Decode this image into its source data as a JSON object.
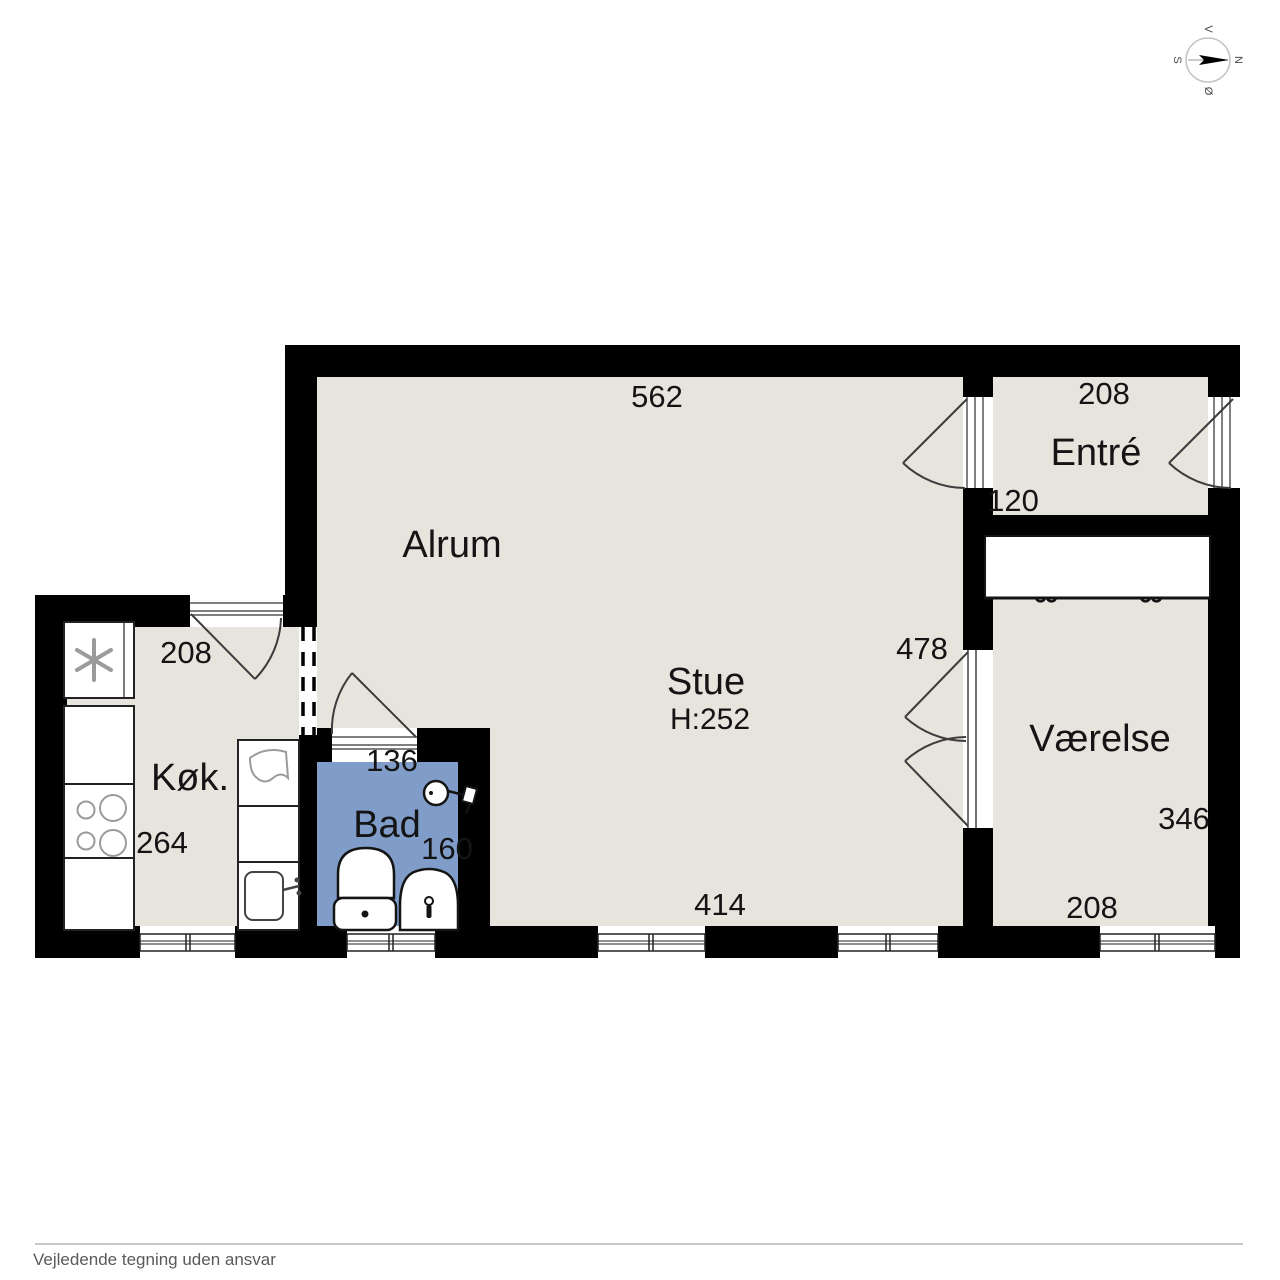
{
  "meta": {
    "footer_note": "Vejledende tegning uden ansvar"
  },
  "compass": {
    "north": "N",
    "south": "S",
    "east": "Ø",
    "west": "V"
  },
  "rooms": [
    {
      "id": "alrum",
      "label": "Alrum"
    },
    {
      "id": "stue",
      "label": "Stue",
      "ceiling_height": "H:252"
    },
    {
      "id": "entre",
      "label": "Entré"
    },
    {
      "id": "vaerelse",
      "label": "Værelse"
    },
    {
      "id": "koekken",
      "label": "Køk."
    },
    {
      "id": "bad",
      "label": "Bad"
    }
  ],
  "dimensions": {
    "stue_top_width": "562",
    "entre_width": "208",
    "entre_depth": "120",
    "stue_door_height": "478",
    "vaerelse_height": "346",
    "vaerelse_width": "208",
    "stue_bottom_width": "414",
    "bad_width": "136",
    "bad_height": "160",
    "koekken_height": "264",
    "koekken_width": "208"
  },
  "colors": {
    "wall": "#000000",
    "floor": "#e7e3dd",
    "wet_room_floor": "#7f9dc8",
    "background": "#ffffff"
  }
}
